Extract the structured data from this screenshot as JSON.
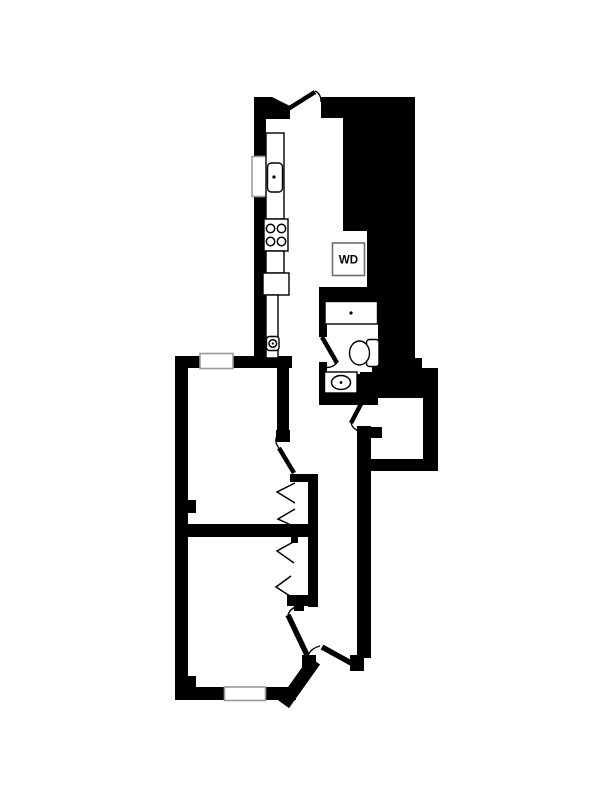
{
  "floorplan": {
    "labels": {
      "washer_dryer": "WD"
    },
    "colors": {
      "background": "#ffffff",
      "wall": "#000000",
      "line": "#000000",
      "window_frame": "#9b9b9b",
      "wd_frame": "#6e6e6e"
    }
  }
}
